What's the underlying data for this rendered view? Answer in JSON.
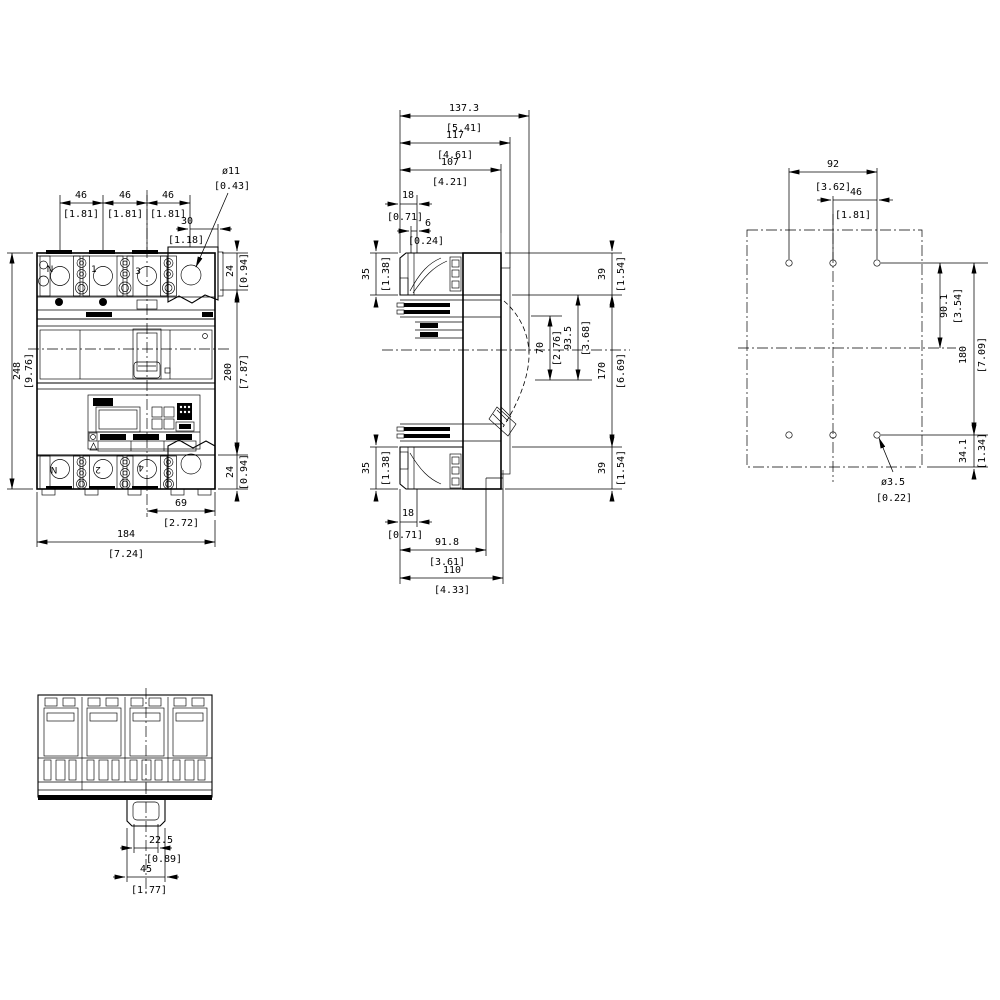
{
  "front": {
    "pole_pitch": {
      "mm": "46",
      "in": "[1.81]"
    },
    "hole_offset": {
      "mm": "30",
      "in": "[1.18]"
    },
    "hole_dia": {
      "mm": "ø11",
      "in": "[0.43]"
    },
    "terminal_h": {
      "mm": "24",
      "in": "[0.94]"
    },
    "overall_h": {
      "mm": "248",
      "in": "[9.76]"
    },
    "base_h": {
      "mm": "200",
      "in": "[7.87]"
    },
    "ext_w": {
      "mm": "69",
      "in": "[2.72]"
    },
    "overall_w": {
      "mm": "184",
      "in": "[7.24]"
    },
    "terminals_top": [
      "N",
      "1",
      "3"
    ],
    "terminals_bottom": [
      "N",
      "2",
      "4"
    ]
  },
  "side": {
    "depth_max": {
      "mm": "137.3",
      "in": "[5.41]"
    },
    "depth_with_rail": {
      "mm": "117",
      "in": "[4.61]"
    },
    "depth_body": {
      "mm": "107",
      "in": "[4.21]"
    },
    "front_depth": {
      "mm": "18",
      "in": "[0.71]"
    },
    "gap": {
      "mm": "6",
      "in": "[0.24]"
    },
    "shroud_h": {
      "mm": "35",
      "in": "[1.38]"
    },
    "terminal_h": {
      "mm": "39",
      "in": "[1.54]"
    },
    "handle_travel": {
      "mm": "70",
      "in": "[2.76]"
    },
    "handle_depth": {
      "mm": "93.5",
      "in": "[3.68]"
    },
    "body_h": {
      "mm": "170",
      "in": "[6.69]"
    },
    "depth_lower": {
      "mm": "91.8",
      "in": "[3.61]"
    },
    "depth_base": {
      "mm": "110",
      "in": "[4.33]"
    }
  },
  "plan": {
    "hole_span": {
      "mm": "92",
      "in": "[3.62]"
    },
    "hole_pitch": {
      "mm": "46",
      "in": "[1.81]"
    },
    "row_to_center": {
      "mm": "90.1",
      "in": "[3.54]"
    },
    "row_span": {
      "mm": "180",
      "in": "[7.09]"
    },
    "row_to_edge": {
      "mm": "34.1",
      "in": "[1.34]"
    },
    "hole_dia": {
      "mm": "ø3.5",
      "in": "[0.22]"
    }
  },
  "bottom": {
    "tab_w": {
      "mm": "22.5",
      "in": "[0.89]"
    },
    "slot_w": {
      "mm": "45",
      "in": "[1.77]"
    }
  }
}
